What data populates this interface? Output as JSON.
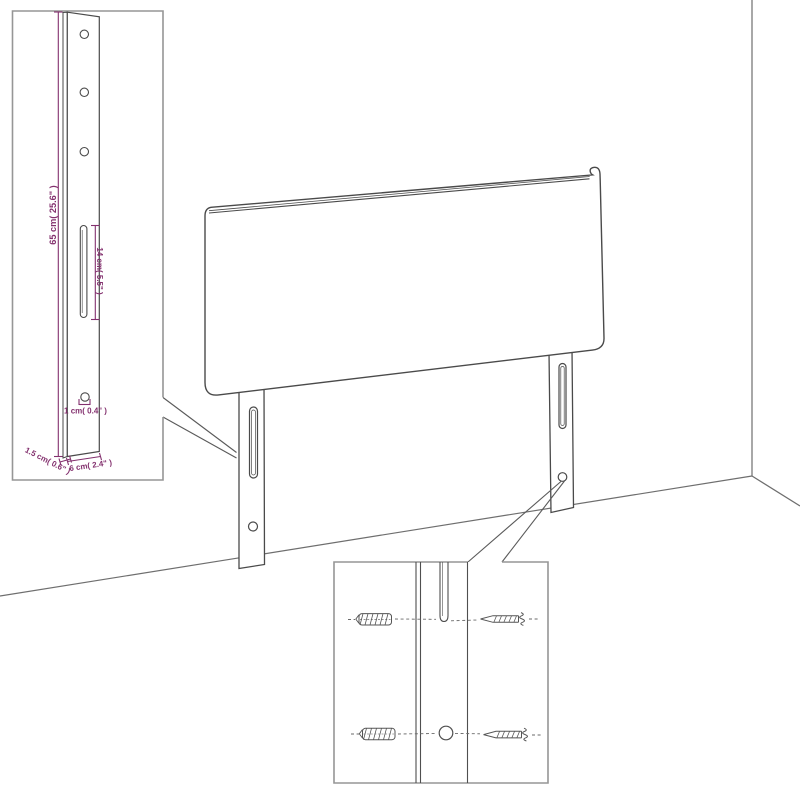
{
  "labels": {
    "post_height": "65 cm( 25.6\" )",
    "slot_height": "14 cm( 5.5\" )",
    "hole_size": "1 cm( 0.4\" )",
    "post_depth": "1.5 cm( 0.6\" )",
    "post_width": "6 cm( 2.4\" )"
  },
  "colors": {
    "dimension_text": "#83306e",
    "line_art": "#4a4a4a",
    "inset_border": "#969696"
  }
}
